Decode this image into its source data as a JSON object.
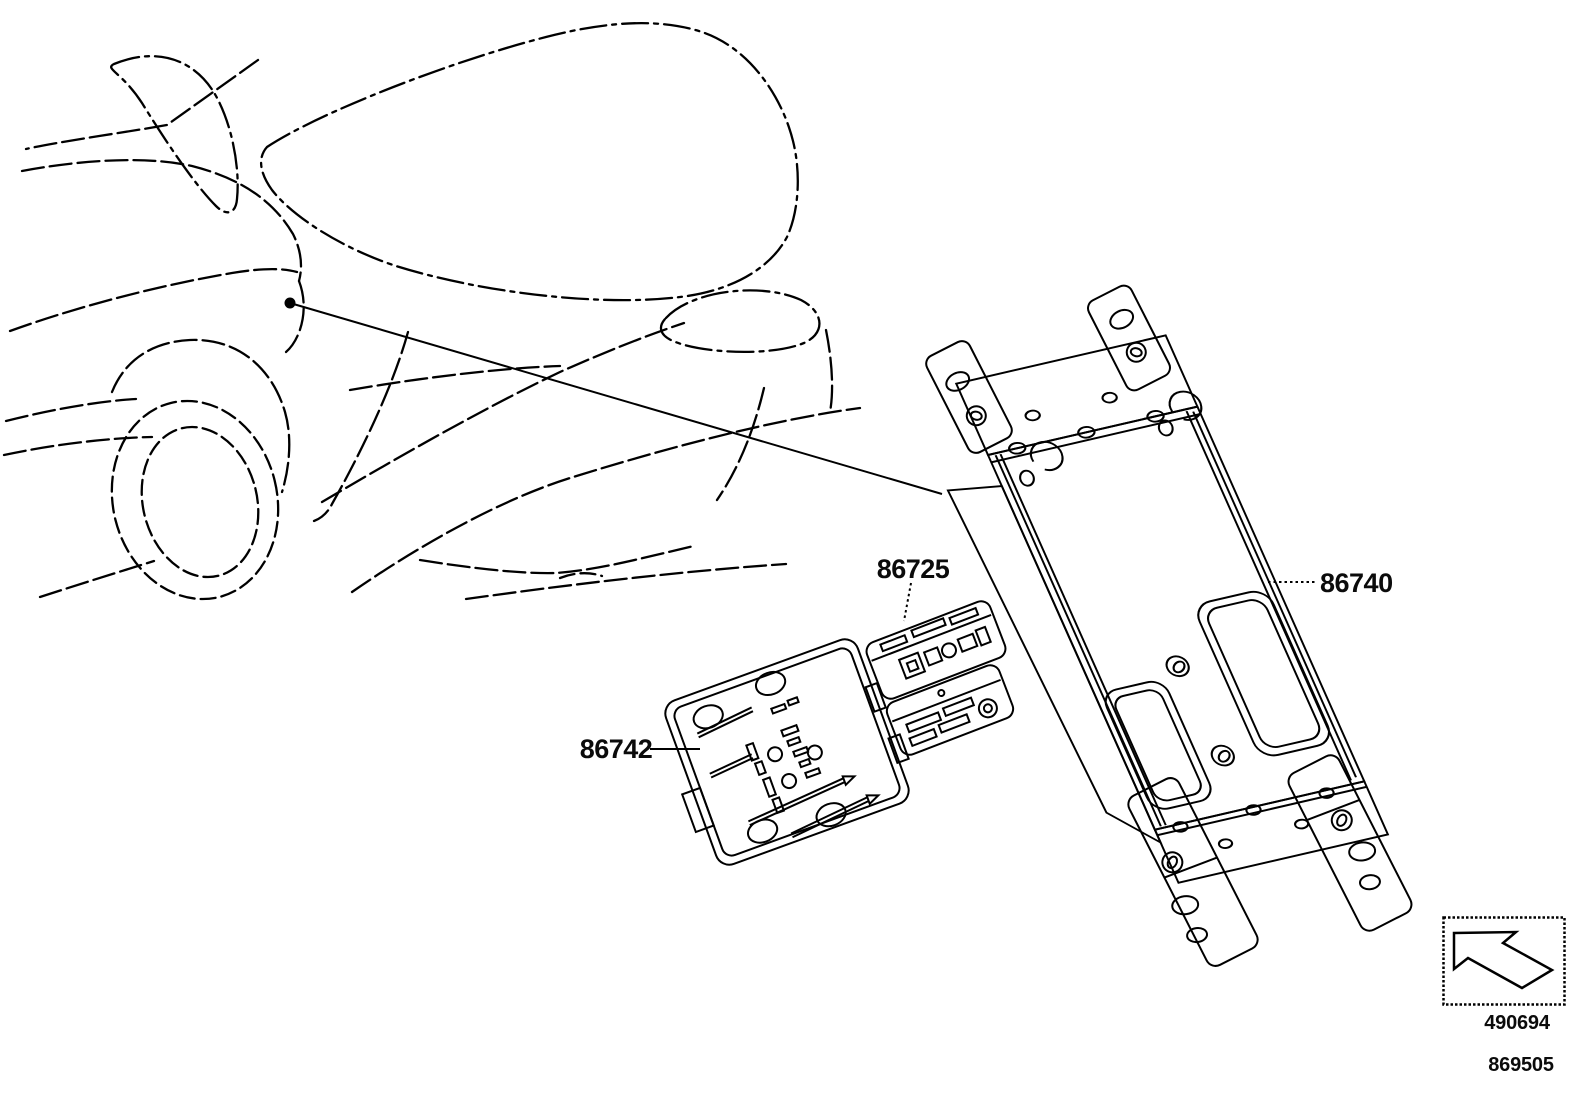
{
  "page": {
    "background_color": "#ffffff",
    "line_color": "#000000",
    "text_color": "#0b0b0b"
  },
  "diagram": {
    "vehicle_outline": "rear three-quarter dashed outline of sports car hatchback",
    "callouts": [
      {
        "part_number": "86725"
      },
      {
        "part_number": "86740"
      },
      {
        "part_number": "86742"
      }
    ],
    "direction_box": {
      "arrow_icon": "up-left-direction-arrow",
      "code": "490694"
    },
    "figure_number": "869505"
  }
}
